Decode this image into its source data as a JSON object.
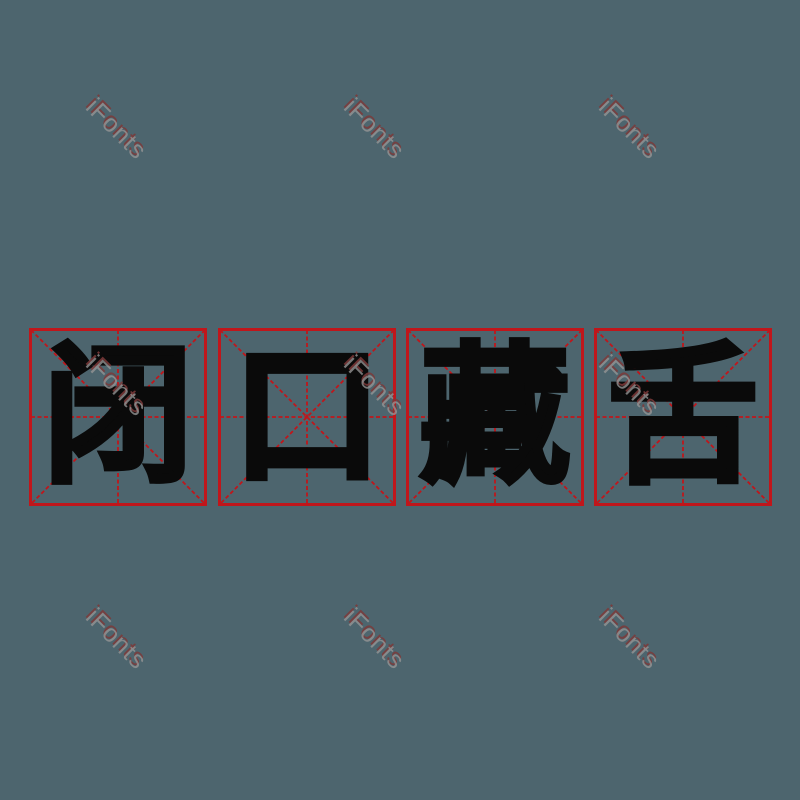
{
  "canvas": {
    "width": 800,
    "height": 800,
    "background_color": "#4d656e"
  },
  "idiom": {
    "text": "闭口藏舌",
    "characters": [
      "闭",
      "口",
      "藏",
      "舌"
    ],
    "character_color": "#0a0a0a"
  },
  "grid": {
    "style": "mi-zi-ge-practice-grid",
    "box_count": 4,
    "line_color": "#c0161b"
  },
  "watermark": {
    "text": "iFonts",
    "gray_color": "#969696",
    "red_shadow_color": "#7d3a3a",
    "rotation_deg": 45
  }
}
